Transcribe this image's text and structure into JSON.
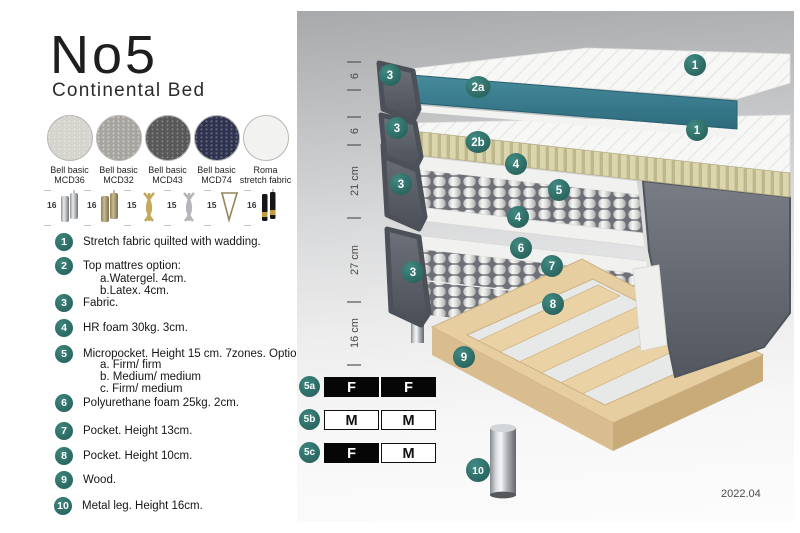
{
  "header": {
    "title": "No5",
    "subtitle": "Continental Bed"
  },
  "fabrics": [
    {
      "name": "Bell basic",
      "code": "MCD36",
      "color": "#d8d6cf"
    },
    {
      "name": "Bell basic",
      "code": "MCD32",
      "color": "#a8a5a0"
    },
    {
      "name": "Bell basic",
      "code": "MCD43",
      "color": "#595959"
    },
    {
      "name": "Bell basic",
      "code": "MCD74",
      "color": "#2f3352"
    },
    {
      "name": "Roma",
      "code": "stretch fabric",
      "color": "#f2f2f1"
    }
  ],
  "legs": [
    {
      "height": "16",
      "style": "cylinder-chrome"
    },
    {
      "height": "16",
      "style": "cylinder-wood"
    },
    {
      "height": "15",
      "style": "twisted-gold"
    },
    {
      "height": "15",
      "style": "twisted-silver"
    },
    {
      "height": "15",
      "style": "hairpin"
    },
    {
      "height": "16",
      "style": "tapered-black-gold"
    }
  ],
  "features": [
    {
      "num": "1",
      "text": "Stretch fabric quilted with wadding."
    },
    {
      "num": "2",
      "text": "Top mattres option:",
      "subs": [
        "a.Watergel. 4cm.",
        "b.Latex. 4cm."
      ]
    },
    {
      "num": "3",
      "text": "Fabric."
    },
    {
      "num": "4",
      "text": "HR foam 30kg. 3cm."
    },
    {
      "num": "5",
      "text": "Micropocket. Height 15 cm. 7zones. Option:",
      "subs": [
        "a. Firm/ firm",
        "b. Medium/ medium",
        "c. Firm/ medium"
      ]
    },
    {
      "num": "6",
      "text": "Polyurethane foam 25kg. 2cm."
    },
    {
      "num": "7",
      "text": "Pocket. Height 13cm."
    },
    {
      "num": "8",
      "text": "Pocket. Height 10cm."
    },
    {
      "num": "9",
      "text": "Wood."
    },
    {
      "num": "10",
      "text": "Metal leg. Height 16cm."
    }
  ],
  "diagram": {
    "badges": [
      {
        "label": "1"
      },
      {
        "label": "3"
      },
      {
        "label": "2a"
      },
      {
        "label": "1"
      },
      {
        "label": "3"
      },
      {
        "label": "2b"
      },
      {
        "label": "4"
      },
      {
        "label": "5"
      },
      {
        "label": "3"
      },
      {
        "label": "4"
      },
      {
        "label": "6"
      },
      {
        "label": "3"
      },
      {
        "label": "7"
      },
      {
        "label": "8"
      },
      {
        "label": "9"
      },
      {
        "label": "10"
      }
    ],
    "ruler": {
      "segments": [
        {
          "label": "6"
        },
        {
          "label": "6"
        },
        {
          "label": "21 cm"
        },
        {
          "label": "27 cm"
        },
        {
          "label": "16 cm"
        }
      ]
    },
    "firmness": [
      {
        "id": "5a",
        "cells": [
          {
            "label": "F",
            "variant": "dark"
          },
          {
            "label": "F",
            "variant": "dark"
          }
        ]
      },
      {
        "id": "5b",
        "cells": [
          {
            "label": "M",
            "variant": "light"
          },
          {
            "label": "M",
            "variant": "light"
          }
        ]
      },
      {
        "id": "5c",
        "cells": [
          {
            "label": "F",
            "variant": "dark"
          },
          {
            "label": "M",
            "variant": "light"
          }
        ]
      }
    ],
    "version": "2022.04"
  },
  "colors": {
    "badge_teal": "#2d6e67",
    "watergel_teal": "#3a7f8e",
    "latex_beige": "#d9d3ab",
    "wood": "#e6cea0",
    "fabric_gray": "#62666e"
  }
}
